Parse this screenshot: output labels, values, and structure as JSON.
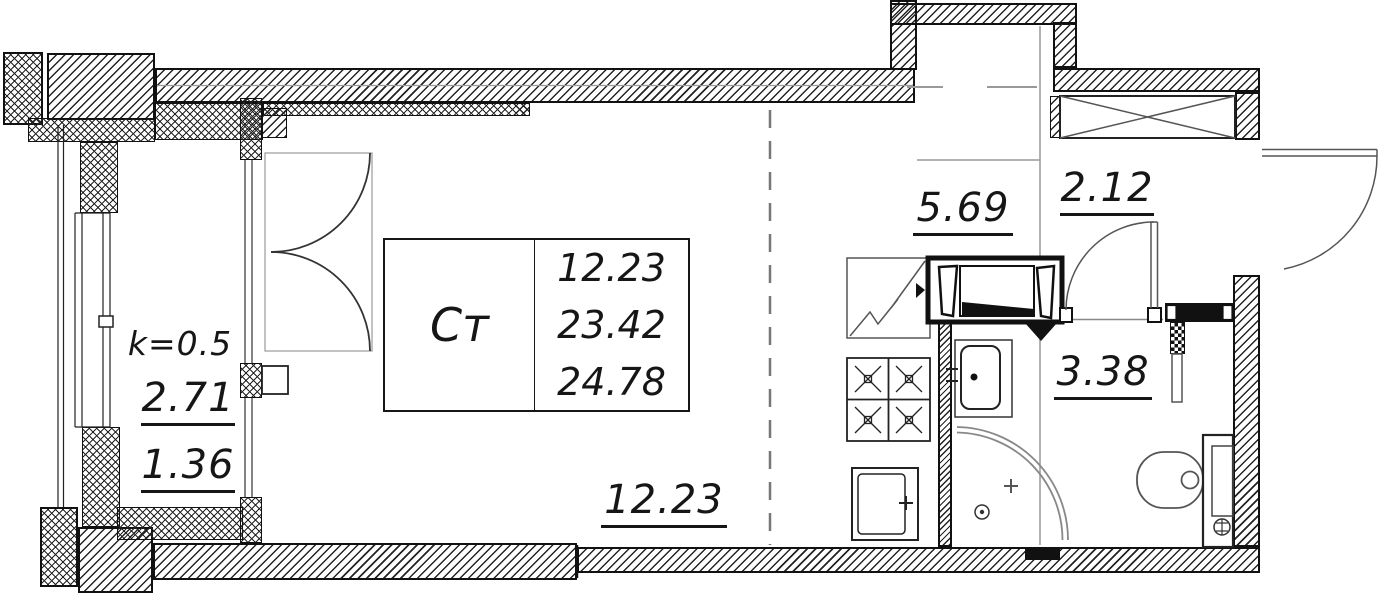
{
  "drawing": {
    "unit_table": {
      "type": "Ст",
      "values": {
        "0": "12.23",
        "1": "23.42",
        "2": "24.78"
      }
    },
    "rooms": {
      "living": {
        "area": "12.23"
      },
      "kitchen": {
        "area": "5.69"
      },
      "hall": {
        "area": "2.12"
      },
      "bath": {
        "area": "3.38"
      }
    },
    "balcony": {
      "coefficient": "k=0.5",
      "area_full": "2.71",
      "area_reduced": "1.36"
    },
    "colors": {
      "line": "#111111",
      "grey_line": "#888888",
      "label": "#161616"
    }
  }
}
